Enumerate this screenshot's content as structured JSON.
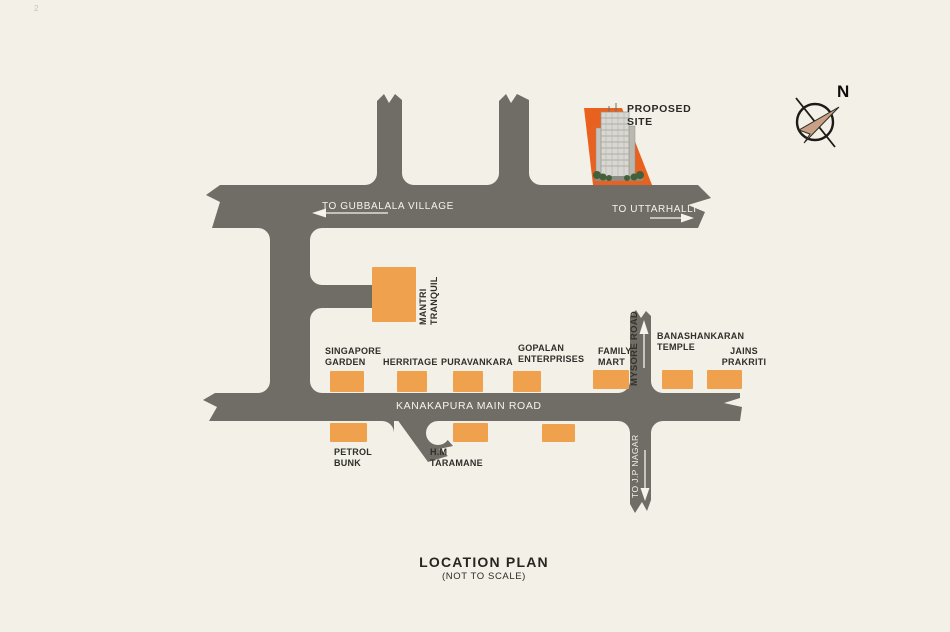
{
  "page": {
    "corner_mark": "2",
    "title": "LOCATION PLAN",
    "subtitle": "(NOT TO SCALE)"
  },
  "colors": {
    "background": "#f3f1e7",
    "road": "#6f6d65",
    "landmark_orange": "#efa14d",
    "proposed_site_orange": "#e8611f",
    "road_text": "#f6f4ea",
    "label_text": "#2f2e2a",
    "compass_arrow_tan": "#c8a184"
  },
  "compass": {
    "label": "N"
  },
  "site": {
    "label": "PROPOSED\nSITE"
  },
  "roads": {
    "top_left_label": "TO GUBBALALA VILLAGE",
    "top_right_label": "TO UTTARHALLI",
    "main_label": "KANAKAPURA MAIN ROAD",
    "mysore_label": "MYSORE ROAD",
    "jp_nagar_label": "TO J.P NAGAR"
  },
  "landmarks": {
    "mantri": "MANTRI\nTRANQUIL",
    "singapore": "SINGAPORE\nGARDEN",
    "herritage": "HERRITAGE",
    "puravankara": "PURAVANKARA",
    "gopalan": "GOPALAN\nENTERPRISES",
    "family_mart": "FAMILY\nMART",
    "banashankaran": "BANASHANKARAN\nTEMPLE",
    "jains": "JAINS\nPRAKRITI",
    "petrol": "PETROL\nBUNK",
    "taramane": "H.M\nTARAMANE"
  }
}
